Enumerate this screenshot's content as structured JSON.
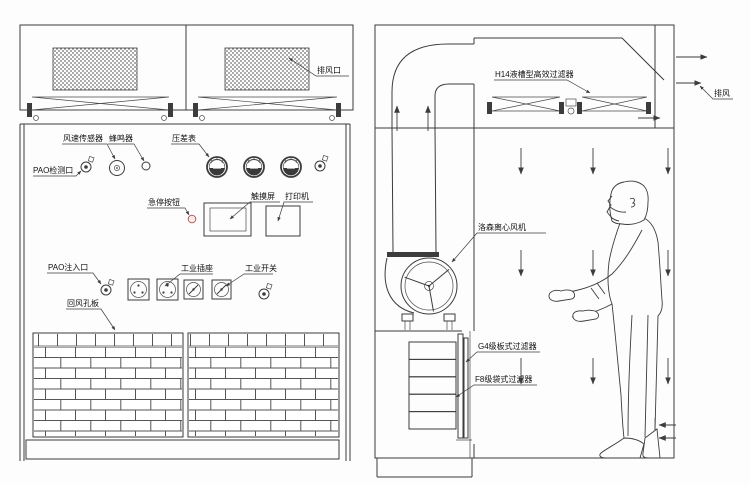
{
  "colors": {
    "line": "#3c3c3c",
    "label_text": "#111111",
    "estop_red": "#b85c5c",
    "background": "#fdfdfd"
  },
  "front_view": {
    "labels": {
      "exhaust_outlet": "排风口",
      "wind_speed_sensor": "风速传感器",
      "buzzer": "蜂鸣器",
      "pao_test_port": "PAO检测口",
      "pressure_gauge": "压差表",
      "emergency_stop": "急停按钮",
      "touch_screen": "触摸屏",
      "printer": "打印机",
      "pao_inject_port": "PAO注入口",
      "industrial_socket": "工业插座",
      "industrial_switch": "工业开关",
      "return_air_plate": "回风孔板"
    }
  },
  "side_view": {
    "labels": {
      "h14_filter": "H14液槽型高效过滤器",
      "exhaust": "排风",
      "centrifugal_fan": "洛森离心风机",
      "g4_filter": "G4级板式过滤器",
      "f8_filter": "F8级袋式过滤器"
    }
  }
}
